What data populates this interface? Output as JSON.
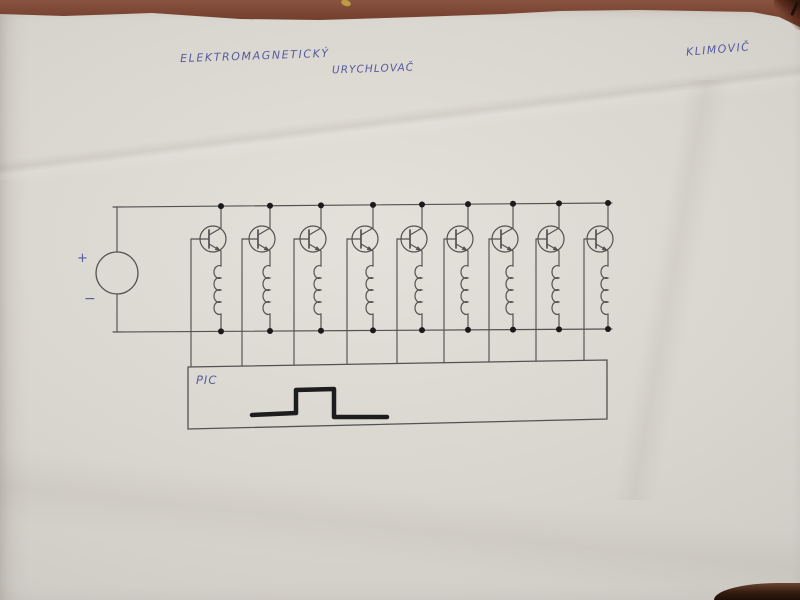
{
  "photo": {
    "table_color": "#7b4430",
    "paper_color": "#d8d5ce",
    "paper_color_light": "#e4e1da",
    "paper_color_dark": "#c5c3be"
  },
  "annotations": {
    "title_line1": "ELEKTROMAGNETICKÝ",
    "title_line2": "URYCHLOVAČ",
    "signature": "KLIMOVIČ",
    "ink_color": "#565b9d"
  },
  "diagram": {
    "pencil_color": "#525250",
    "dot_color": "#1a1a1a",
    "pulse_color": "#1d1d1d",
    "top_rail": {
      "x1": 113,
      "y1": 207,
      "x2": 612,
      "y2": 203
    },
    "bottom_rail": {
      "x1": 113,
      "y1": 332,
      "x2": 612,
      "y2": 329
    },
    "source": {
      "cx": 117,
      "cy": 273,
      "r": 21,
      "plus": "+",
      "minus": "−",
      "plus_x": 77,
      "plus_y": 262,
      "minus_x": 84,
      "minus_y": 303
    },
    "transistor": {
      "cy": 239,
      "r": 13
    },
    "coil": {
      "top_y": 263,
      "loop_h": 12,
      "loops": 4
    },
    "stages": [
      {
        "x": 221,
        "base_x": 191
      },
      {
        "x": 270,
        "base_x": 242
      },
      {
        "x": 321,
        "base_x": 294
      },
      {
        "x": 373,
        "base_x": 347
      },
      {
        "x": 422,
        "base_x": 397
      },
      {
        "x": 468,
        "base_x": 444
      },
      {
        "x": 513,
        "base_x": 489
      },
      {
        "x": 559,
        "base_x": 536
      },
      {
        "x": 608,
        "base_x": 584
      }
    ],
    "pic_box": {
      "label": "PIC",
      "x1": 188,
      "y_tl": 367,
      "x2": 607,
      "y_tr": 360,
      "y_br": 419,
      "y_bl": 429,
      "label_x": 196,
      "label_y": 384
    },
    "pulse_points": [
      [
        252,
        415
      ],
      [
        296,
        413
      ],
      [
        296,
        390
      ],
      [
        334,
        389
      ],
      [
        334,
        417
      ],
      [
        387,
        417
      ]
    ]
  }
}
